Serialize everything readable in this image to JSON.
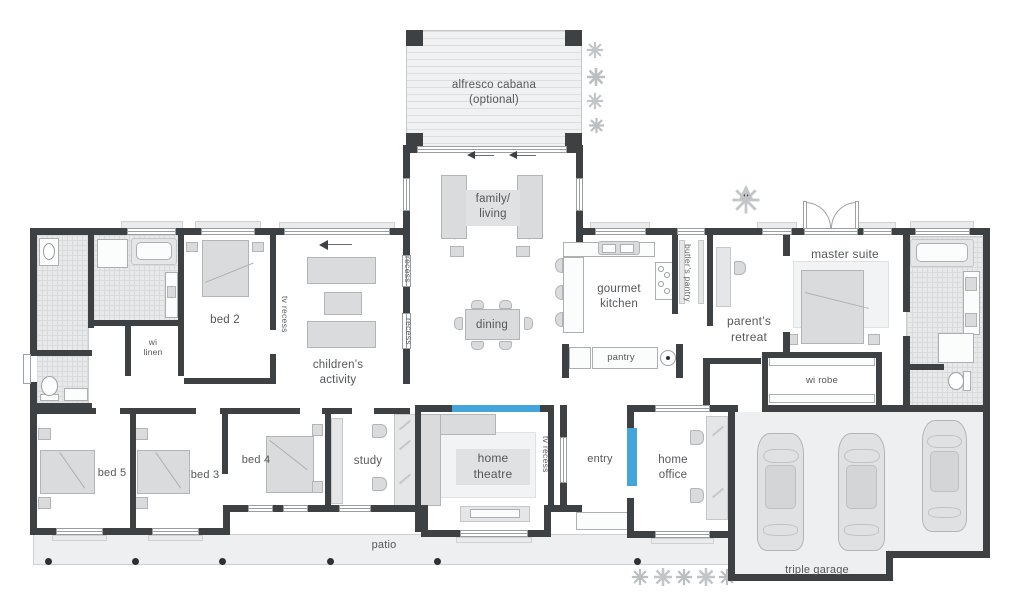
{
  "colors": {
    "wall": "#3e4144",
    "accent_blue": "#44a5da",
    "text": "#54575a",
    "tile": "#e7e9ea",
    "furniture": "#d9dbdd"
  },
  "plan": {
    "outdoor": {
      "alfresco_line1": "alfresco cabana",
      "alfresco_line2": "(optional)",
      "patio": "patio",
      "garage": "triple garage"
    },
    "living": {
      "family_line1": "family/",
      "family_line2": "living",
      "dining": "dining",
      "children_line1": "children’s",
      "children_line2": "activity",
      "study": "study",
      "theatre_line1": "home",
      "theatre_line2": "theatre",
      "entry": "entry",
      "office_line1": "home",
      "office_line2": "office"
    },
    "kitchen": {
      "kitchen_line1": "gourmet",
      "kitchen_line2": "kitchen",
      "butlers": "butler’s pantry",
      "pantry": "pantry"
    },
    "bedrooms": {
      "master": "master suite",
      "parents_line1": "parent’s",
      "parents_line2": "retreat",
      "bed2": "bed 2",
      "bed3": "bed 3",
      "bed4": "bed 4",
      "bed5": "bed 5",
      "wi_robe": "wi robe",
      "wi_linen_line1": "wi",
      "wi_linen_line2": "linen"
    },
    "annotations": {
      "recess": "recess",
      "tv_recess": "tv recess"
    }
  }
}
